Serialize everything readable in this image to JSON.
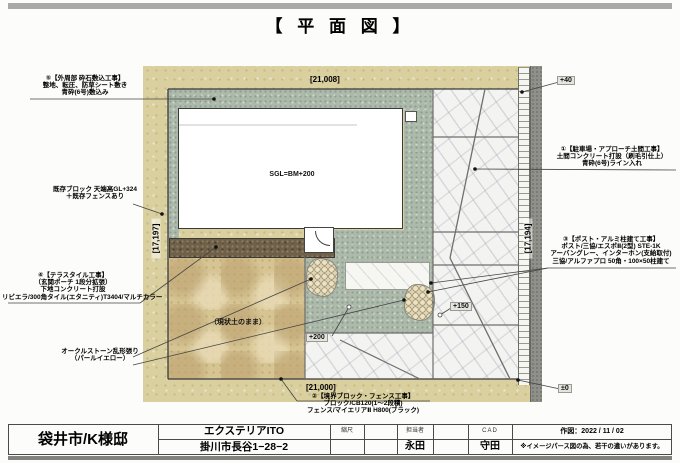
{
  "page": {
    "title": "【 平 面 図 】"
  },
  "plan": {
    "dims": {
      "top": "[21,008]",
      "bottom": "[21,000]",
      "left": "[17,197]",
      "right": "[17,194]"
    },
    "levels": {
      "plus40": "+40",
      "plus150": "+150",
      "plus200": "+200",
      "zero": "±0"
    },
    "house_label": "SGL=BM+200",
    "soil_label": "（現状土のまま）",
    "annotations": {
      "perimeter": {
        "lines": [
          "⑤【外周部 砕石敷込工事】",
          "整地、転圧、防草シート敷き",
          "青砕(6号)敷込み"
        ]
      },
      "existing_block": {
        "lines": [
          "既存ブロック 天端高GL+324",
          "＋既存フェンスあり"
        ]
      },
      "terrace_tile": {
        "lines": [
          "④【テラスタイル工事】",
          "（玄関ポーチ 1段分拡張）",
          "下地コンクリート打設",
          "リビエラ/300角タイル(エタニティ)T3404/マルチカラー"
        ]
      },
      "ocher_stone": {
        "lines": [
          "オークルストーン乱形張り",
          "（パールイエロー）"
        ]
      },
      "parking": {
        "lines": [
          "①【駐車場・アプローチ土間工事】",
          "土間コンクリート打設（刷毛引仕上）",
          "青砕(6号)ライン入れ"
        ]
      },
      "post": {
        "lines": [
          "③【ポスト・アルミ柱建て工事】",
          "ポスト/三協/エスポⅡ(2型) STE-1K",
          "アーバングレー、インターホン(支給取付)",
          "三協/アルファプロ 50角・100×50柱建て"
        ]
      },
      "boundary_fence": {
        "lines": [
          "②【境界ブロック・フェンス工事】",
          "ブロック/CB120(1〜2段積)",
          "フェンス/マイエリアⅡ H800(ブラック)"
        ]
      }
    }
  },
  "title_block": {
    "client": "袋井市/K様邸",
    "company": "エクステリアITO",
    "address": "掛川市長谷1−28−2",
    "scale_label": "縮尺",
    "staff_label": "担当者",
    "staff": "永田",
    "cad_label": "CAD",
    "cad": "守田",
    "date": "作図：2022 / 11 / 02",
    "note": "※イメージパース図の為、若干の違いがあります。"
  },
  "colors": {
    "gravel_green": "#adb9ab",
    "ground_tan": "#d9cf9f",
    "tile_brown": "#6f6049",
    "concrete_white": "#f3f3f1",
    "road_gray": "#90908b",
    "bar_gray": "#a9a9a5"
  }
}
